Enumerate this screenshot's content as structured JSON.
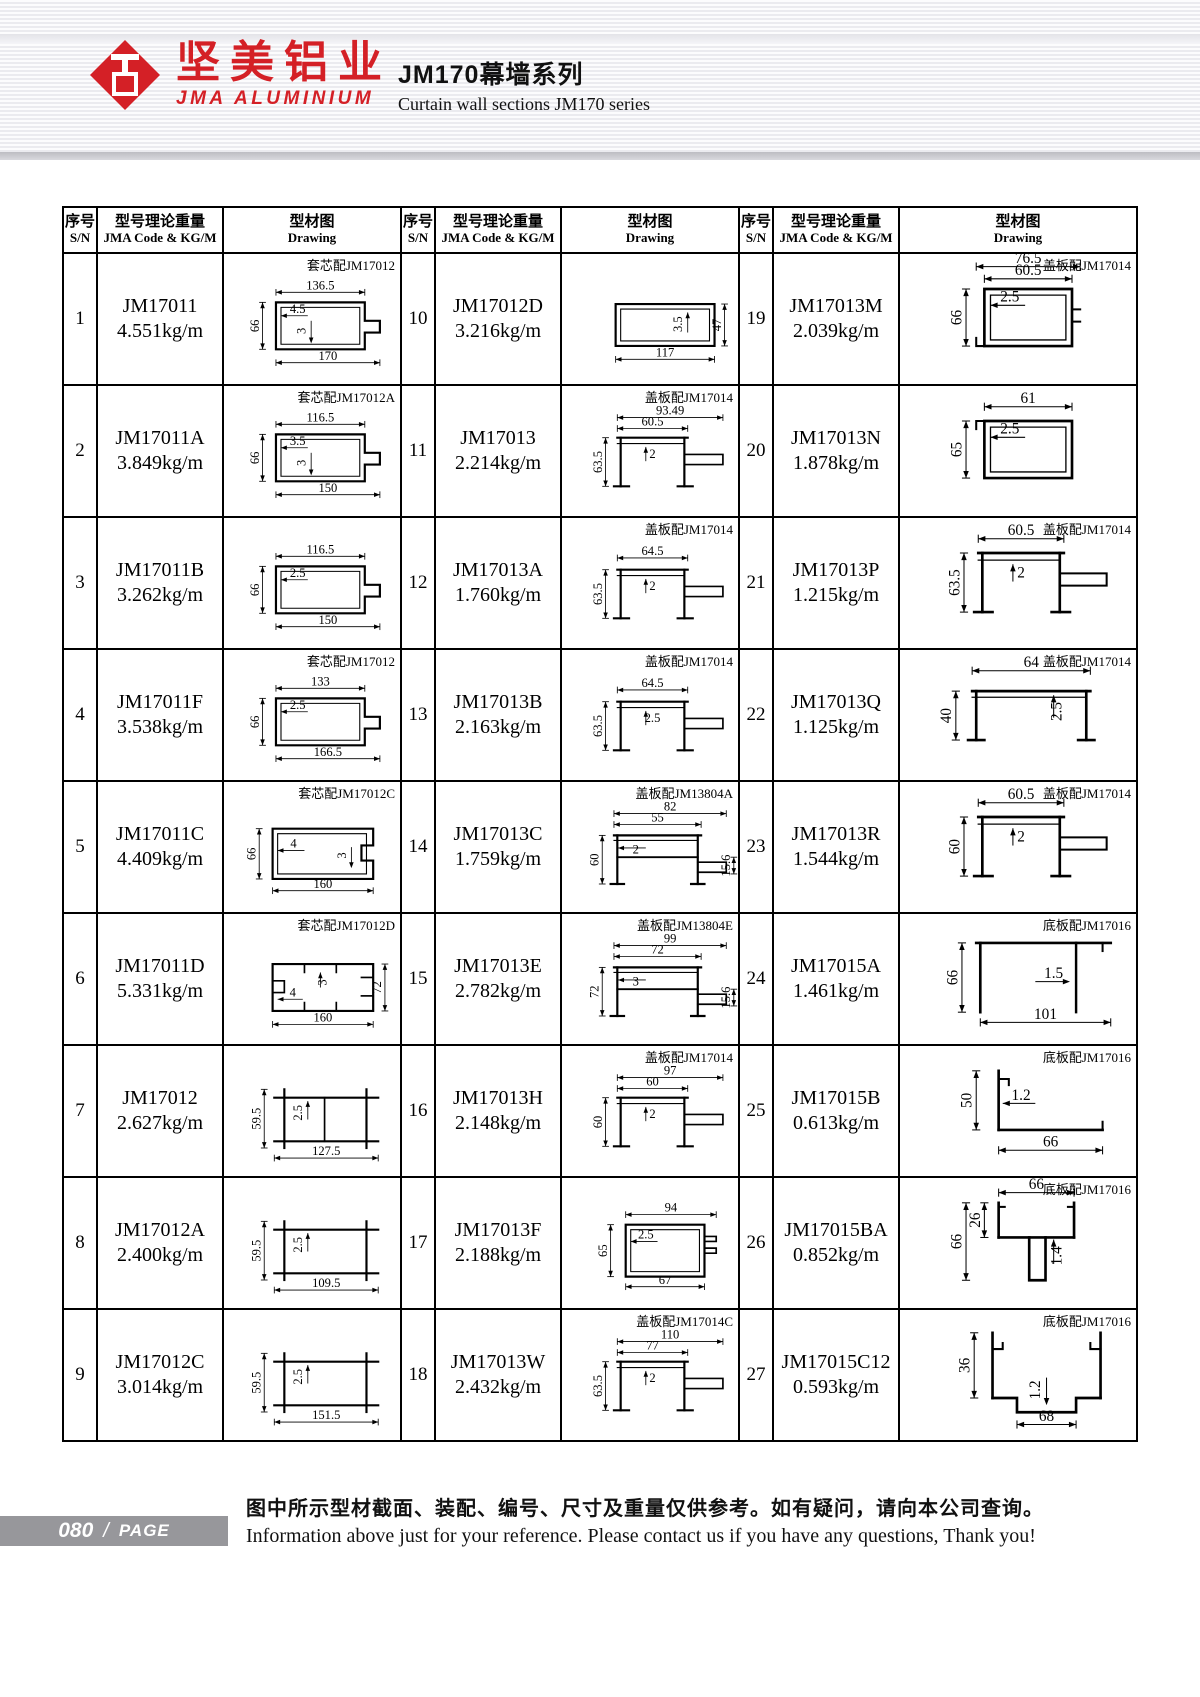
{
  "header": {
    "logo_cn": "坚美铝业",
    "logo_en": "JMA ALUMINIUM",
    "title_cn": "JM170幕墙系列",
    "title_en": "Curtain wall sections JM170 series"
  },
  "table": {
    "col_headers": {
      "sn_cn": "序号",
      "sn_en": "S/N",
      "code_cn": "型号理论重量",
      "code_en": "JMA Code & KG/M",
      "draw_cn": "型材图",
      "draw_en": "Drawing"
    }
  },
  "items": [
    {
      "sn": "1",
      "code": "JM17011",
      "weight": "4.551kg/m",
      "note": "套芯配JM17012",
      "dims": {
        "top1": "136.5",
        "left": "66",
        "i1": "4.5",
        "i2": "3",
        "bottom": "170"
      }
    },
    {
      "sn": "2",
      "code": "JM17011A",
      "weight": "3.849kg/m",
      "note": "套芯配JM17012A",
      "dims": {
        "top1": "116.5",
        "left": "66",
        "i1": "3.5",
        "i2": "3",
        "bottom": "150"
      }
    },
    {
      "sn": "3",
      "code": "JM17011B",
      "weight": "3.262kg/m",
      "note": "",
      "dims": {
        "top1": "116.5",
        "left": "66",
        "i1": "2.5",
        "bottom": "150"
      }
    },
    {
      "sn": "4",
      "code": "JM17011F",
      "weight": "3.538kg/m",
      "note": "套芯配JM17012",
      "dims": {
        "top1": "133",
        "left": "66",
        "i1": "2.5",
        "bottom": "166.5"
      }
    },
    {
      "sn": "5",
      "code": "JM17011C",
      "weight": "4.409kg/m",
      "note": "套芯配JM17012C",
      "dims": {
        "left": "66",
        "i1": "4",
        "i2": "3",
        "bottom": "160"
      }
    },
    {
      "sn": "6",
      "code": "JM17011D",
      "weight": "5.331kg/m",
      "note": "套芯配JM17012D",
      "dims": {
        "i1": "3",
        "i2": "4",
        "bottom": "160",
        "right": "72"
      }
    },
    {
      "sn": "7",
      "code": "JM17012",
      "weight": "2.627kg/m",
      "note": "",
      "dims": {
        "left": "59.5",
        "i1": "2.5",
        "bottom": "127.5"
      }
    },
    {
      "sn": "8",
      "code": "JM17012A",
      "weight": "2.400kg/m",
      "note": "",
      "dims": {
        "left": "59.5",
        "i1": "2.5",
        "bottom": "109.5"
      }
    },
    {
      "sn": "9",
      "code": "JM17012C",
      "weight": "3.014kg/m",
      "note": "",
      "dims": {
        "left": "59.5",
        "i1": "2.5",
        "bottom": "151.5"
      }
    },
    {
      "sn": "10",
      "code": "JM17012D",
      "weight": "3.216kg/m",
      "note": "",
      "dims": {
        "i1": "3.5",
        "right": "47",
        "bottom": "117"
      }
    },
    {
      "sn": "11",
      "code": "JM17013",
      "weight": "2.214kg/m",
      "note": "盖板配JM17014",
      "dims": {
        "top1": "93.49",
        "top2": "60.5",
        "i1": "2",
        "left": "63.5"
      }
    },
    {
      "sn": "12",
      "code": "JM17013A",
      "weight": "1.760kg/m",
      "note": "盖板配JM17014",
      "dims": {
        "top1": "64.5",
        "i1": "2",
        "left": "63.5"
      }
    },
    {
      "sn": "13",
      "code": "JM17013B",
      "weight": "2.163kg/m",
      "note": "盖板配JM17014",
      "dims": {
        "top1": "64.5",
        "i1": "2.5",
        "left": "63.5"
      }
    },
    {
      "sn": "14",
      "code": "JM17013C",
      "weight": "1.759kg/m",
      "note": "盖板配JM13804A",
      "dims": {
        "top1": "82",
        "top2": "55",
        "i1": "2",
        "left": "60",
        "right": "15.6"
      }
    },
    {
      "sn": "15",
      "code": "JM17013E",
      "weight": "2.782kg/m",
      "note": "盖板配JM13804E",
      "dims": {
        "top1": "99",
        "top2": "72",
        "i1": "3",
        "left": "72",
        "right": "15.6"
      }
    },
    {
      "sn": "16",
      "code": "JM17013H",
      "weight": "2.148kg/m",
      "note": "盖板配JM17014",
      "dims": {
        "top1": "97",
        "top2": "60",
        "i1": "2",
        "left": "60"
      }
    },
    {
      "sn": "17",
      "code": "JM17013F",
      "weight": "2.188kg/m",
      "note": "",
      "dims": {
        "top1": "94",
        "left": "65",
        "i1": "2.5",
        "bottom": "67"
      }
    },
    {
      "sn": "18",
      "code": "JM17013W",
      "weight": "2.432kg/m",
      "note": "盖板配JM17014C",
      "dims": {
        "top1": "110",
        "top2": "77",
        "i1": "2",
        "left": "63.5"
      }
    },
    {
      "sn": "19",
      "code": "JM17013M",
      "weight": "2.039kg/m",
      "note": "盖板配JM17014",
      "dims": {
        "top1": "76.5",
        "top2": "60.5",
        "i1": "2.5",
        "left": "66"
      }
    },
    {
      "sn": "20",
      "code": "JM17013N",
      "weight": "1.878kg/m",
      "note": "",
      "dims": {
        "top1": "61",
        "i1": "2.5",
        "left": "65"
      }
    },
    {
      "sn": "21",
      "code": "JM17013P",
      "weight": "1.215kg/m",
      "note": "盖板配JM17014",
      "dims": {
        "top1": "60.5",
        "i1": "2",
        "left": "63.5"
      }
    },
    {
      "sn": "22",
      "code": "JM17013Q",
      "weight": "1.125kg/m",
      "note": "盖板配JM17014",
      "dims": {
        "top1": "64",
        "i1": "2.5",
        "left": "40"
      }
    },
    {
      "sn": "23",
      "code": "JM17013R",
      "weight": "1.544kg/m",
      "note": "盖板配JM17014",
      "dims": {
        "top1": "60.5",
        "i1": "2",
        "left": "60"
      }
    },
    {
      "sn": "24",
      "code": "JM17015A",
      "weight": "1.461kg/m",
      "note": "底板配JM17016",
      "dims": {
        "left": "66",
        "i1": "1.5",
        "bottom": "101"
      }
    },
    {
      "sn": "25",
      "code": "JM17015B",
      "weight": "0.613kg/m",
      "note": "底板配JM17016",
      "dims": {
        "left": "50",
        "i1": "1.2",
        "bottom": "66"
      }
    },
    {
      "sn": "26",
      "code": "JM17015BA",
      "weight": "0.852kg/m",
      "note": "底板配JM17016",
      "dims": {
        "top1": "66",
        "left2": "26",
        "left": "66",
        "i1": "1.4"
      }
    },
    {
      "sn": "27",
      "code": "JM17015C12",
      "weight": "0.593kg/m",
      "note": "底板配JM17016",
      "dims": {
        "left": "36",
        "i1": "1.2",
        "bottom": "68"
      }
    }
  ],
  "footer": {
    "page": "080",
    "sep": "/",
    "page_label": "PAGE",
    "note_cn": "图中所示型材截面、装配、编号、尺寸及重量仅供参考。如有疑问，请向本公司查询。",
    "note_en": "Information above just for your reference. Please contact us if you have any questions, Thank you!"
  },
  "colors": {
    "brand_red": "#d42026",
    "line": "#000000",
    "badge_bg": "#97979b"
  }
}
